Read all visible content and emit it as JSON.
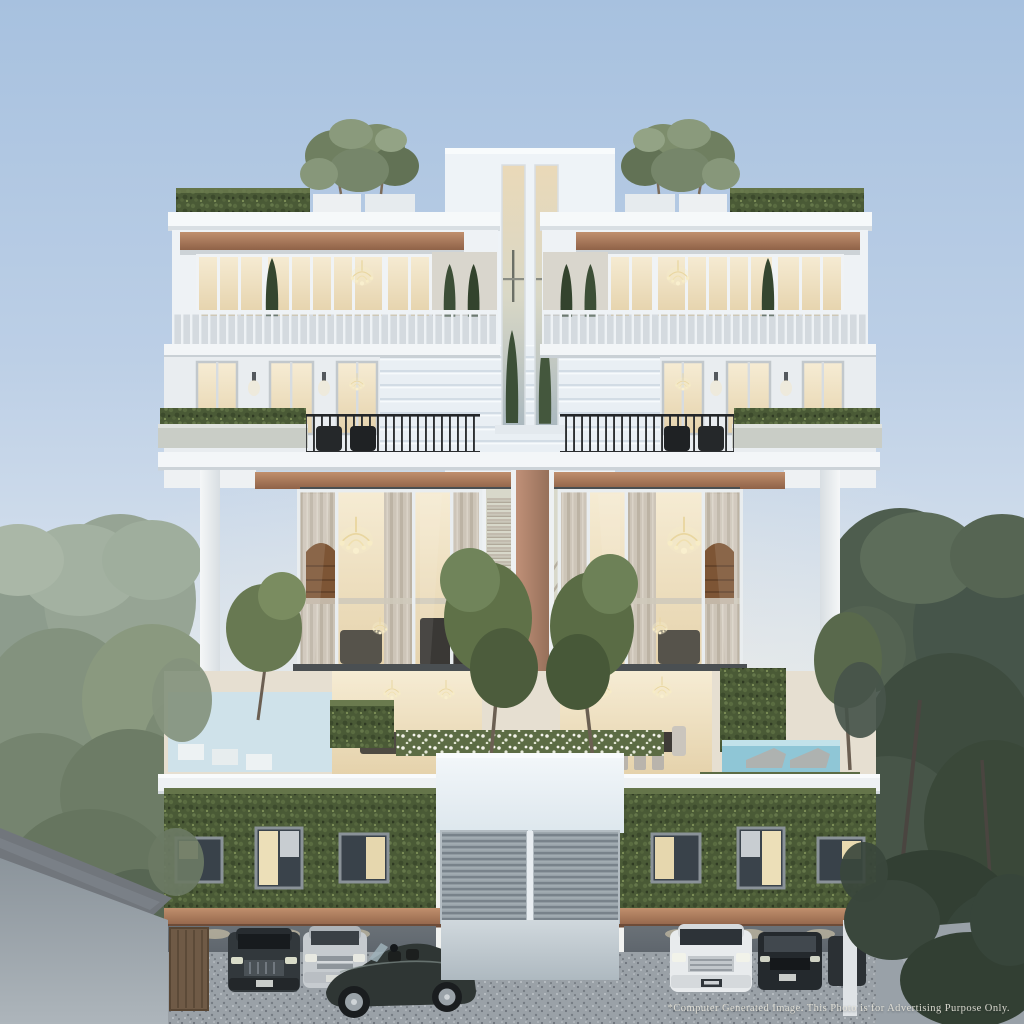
{
  "image": {
    "type": "architectural-rendering",
    "subject": "Symmetrical modern luxury residence at dusk: rooftop trees and hedges, warm-lit penthouse, planted balconies, double-height curtained glass living halls, terrace with reflecting pond and swimming pool, ivy-covered podium and basement carport with parked cars",
    "caption": "*Computer Generated Image. This Photo is for Advertising Purpose Only."
  },
  "scene": {
    "rooftop": [
      "potted trees",
      "hedge rows"
    ],
    "middle": [
      "chandeliers",
      "cypress planters",
      "balcony railings"
    ],
    "terrace": [
      "reflecting pond",
      "swimming pool",
      "sun loungers",
      "dining table",
      "white flower planters"
    ],
    "podium": [
      "green living wall",
      "roller garage doors",
      "lit windows"
    ],
    "carport_cars": [
      "dark SUV",
      "silver sedan",
      "dark convertible roadster",
      "white SUV",
      "dark minivan"
    ]
  },
  "palette": {
    "sky_top": "#a7c1df",
    "sky_horizon": "#f2f4f5",
    "building_white": "#eef2f5",
    "copper_trim": "#a97a5e",
    "warm_light": "#f0e2c2",
    "hedge_green": "#4a5a36",
    "trees_left": "#8d9c8d",
    "trees_right": "#47564a",
    "pool_blue": "#8fc6d6",
    "ground_grey": "#9aa1a7"
  }
}
